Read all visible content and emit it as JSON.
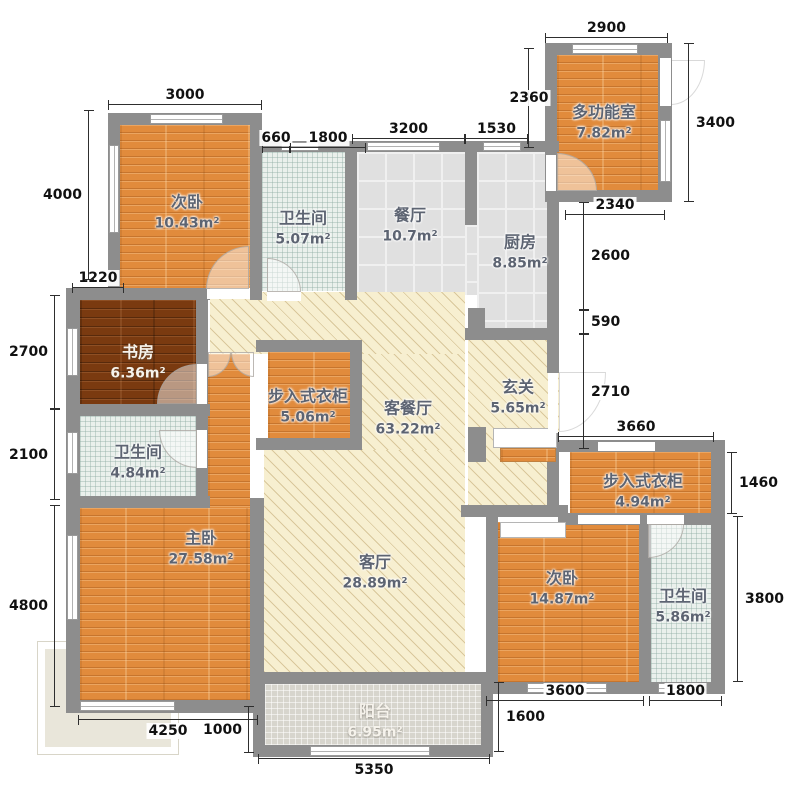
{
  "plan_type": "apartment-floor-plan",
  "rooms": {
    "ciwo_top": {
      "name": "次卧",
      "area": "10.43m²"
    },
    "wsj_top": {
      "name": "卫生间",
      "area": "5.07m²"
    },
    "canting": {
      "name": "餐厅",
      "area": "10.7m²"
    },
    "chufang": {
      "name": "厨房",
      "area": "8.85m²"
    },
    "duogongneng": {
      "name": "多功能室",
      "area": "7.82m²"
    },
    "shufang": {
      "name": "书房",
      "area": "6.36m²"
    },
    "closet_left": {
      "name": "步入式衣柜",
      "area": "5.06m²"
    },
    "kecanting": {
      "name": "客餐厅",
      "area": "63.22m²"
    },
    "xuanguan": {
      "name": "玄关",
      "area": "5.65m²"
    },
    "wsj_left": {
      "name": "卫生间",
      "area": "4.84m²"
    },
    "zhuwo": {
      "name": "主卧",
      "area": "27.58m²"
    },
    "keting": {
      "name": "客厅",
      "area": "28.89m²"
    },
    "ciwo_right": {
      "name": "次卧",
      "area": "14.87m²"
    },
    "closet_right": {
      "name": "步入式衣柜",
      "area": "4.94m²"
    },
    "wsj_right": {
      "name": "卫生间",
      "area": "5.86m²"
    },
    "yangtai": {
      "name": "阳台",
      "area": "6.95m²"
    }
  },
  "dims": {
    "d2900": "2900",
    "d3000": "3000",
    "d660": "660",
    "d1800_top": "1800",
    "d3200": "3200",
    "d1530": "1530",
    "d2360": "2360",
    "d3400": "3400",
    "d2340": "2340",
    "d2600": "2600",
    "d590": "590",
    "d2710": "2710",
    "d3660": "3660",
    "d1460": "1460",
    "d3800": "3800",
    "d4000": "4000",
    "d1220": "1220",
    "d2700": "2700",
    "d2100": "2100",
    "d4800": "4800",
    "d4250": "4250",
    "d1000": "1000",
    "d5350": "5350",
    "d1600": "1600",
    "d3600": "3600",
    "d1800_bottom": "1800"
  },
  "colors": {
    "wall": "#8d8d8d",
    "wood": "#e18b3c",
    "dark_wood": "#7a3a10",
    "hatch_floor": "#f7efd0",
    "gray_tile": "#e0e0e0",
    "bath_tile": "#eaf0ec",
    "balcony_mosaic": "#d7d5cd",
    "dimension_text": "#111111"
  }
}
